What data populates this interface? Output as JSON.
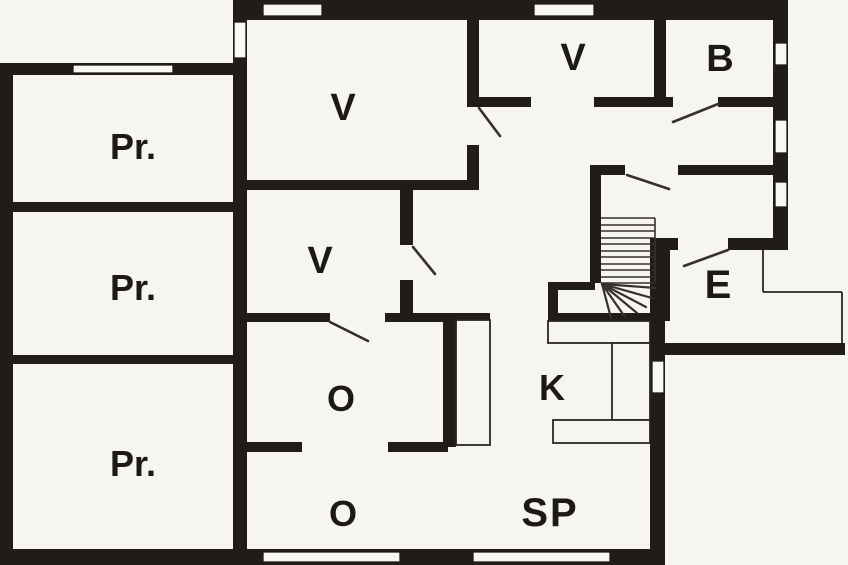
{
  "plan": {
    "type": "floor-plan",
    "colors": {
      "background": "#f6f5f1",
      "wall": "#201c18",
      "thin_line": "#2a2621"
    },
    "rooms": [
      {
        "id": "pr-1",
        "label": "Pr."
      },
      {
        "id": "pr-2",
        "label": "Pr."
      },
      {
        "id": "pr-3",
        "label": "Pr."
      },
      {
        "id": "v-top-center",
        "label": "V"
      },
      {
        "id": "v-middle",
        "label": "V"
      },
      {
        "id": "v-top-right",
        "label": "V"
      },
      {
        "id": "b",
        "label": "B"
      },
      {
        "id": "e",
        "label": "E"
      },
      {
        "id": "k",
        "label": "K"
      },
      {
        "id": "o-upper",
        "label": "O"
      },
      {
        "id": "o-lower",
        "label": "O"
      },
      {
        "id": "sp",
        "label": "SP"
      }
    ],
    "features": {
      "staircase": "straight run with winder turn",
      "windows": 10,
      "door_swings": 6
    }
  }
}
